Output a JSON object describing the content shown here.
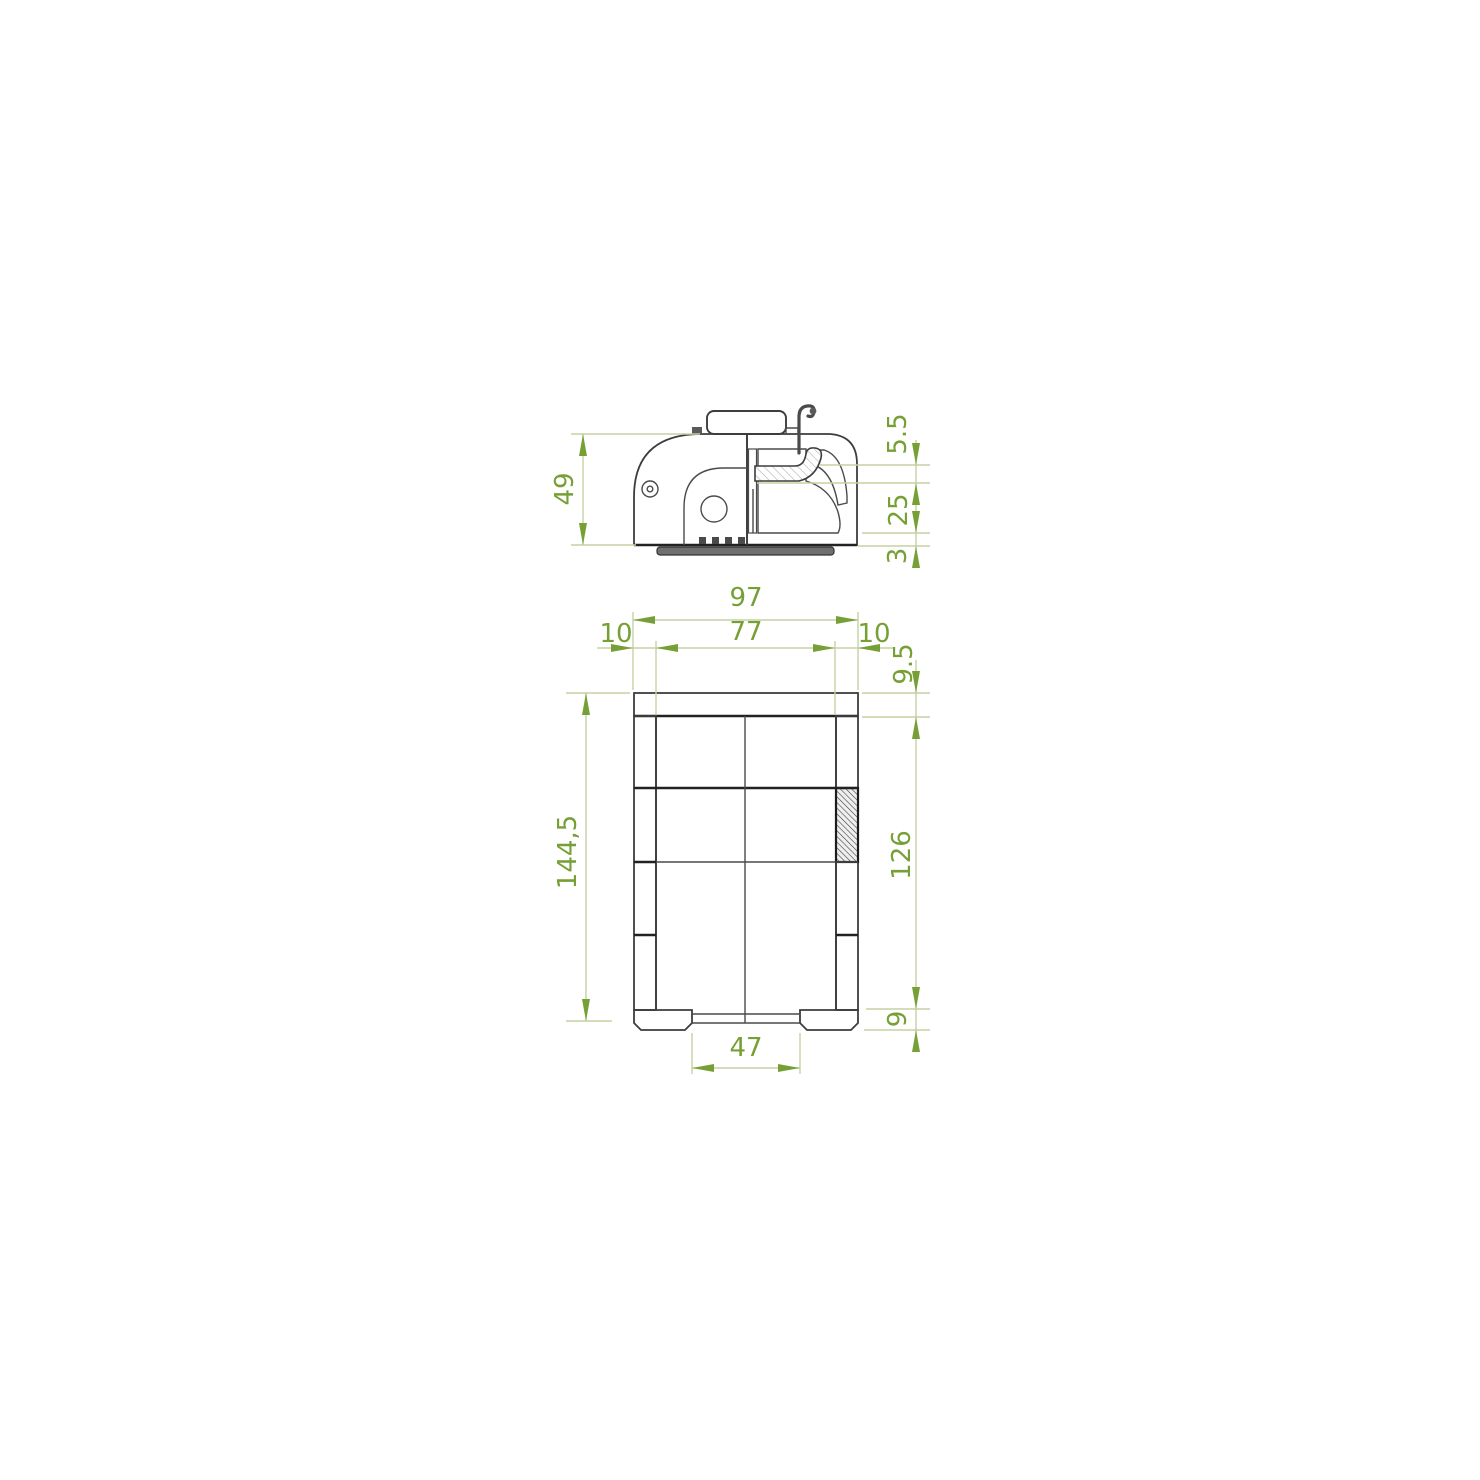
{
  "drawing": {
    "type": "technical-dimensioned-drawing",
    "views": {
      "side_section_view": {
        "description": "upper view: side cross-section of latch body with wire hook and base plate",
        "dimensions": {
          "overall_height": "49",
          "top_gap": "5.5",
          "catch_depth": "25",
          "base_plate_thickness": "3"
        }
      },
      "front_section_view": {
        "description": "lower view: front sectional frame with hatched walls, feet and bottom opening",
        "dimensions": {
          "overall_width": "97",
          "inner_width": "77",
          "wall_left": "10",
          "wall_right": "10",
          "top_wall_thickness": "9.5",
          "overall_height": "144,5",
          "inner_height": "126",
          "foot_height": "9",
          "opening_width": "47"
        }
      }
    },
    "colors": {
      "dimension_text": "#76a036",
      "dimension_lines": "#c6d1a4",
      "outline": "#3d3d3d",
      "hatch": "#a9a9a9",
      "dark_hatch_block": "#3f3f3f",
      "base_plate_fill": "#6f6f6f",
      "background": "#ffffff"
    }
  }
}
